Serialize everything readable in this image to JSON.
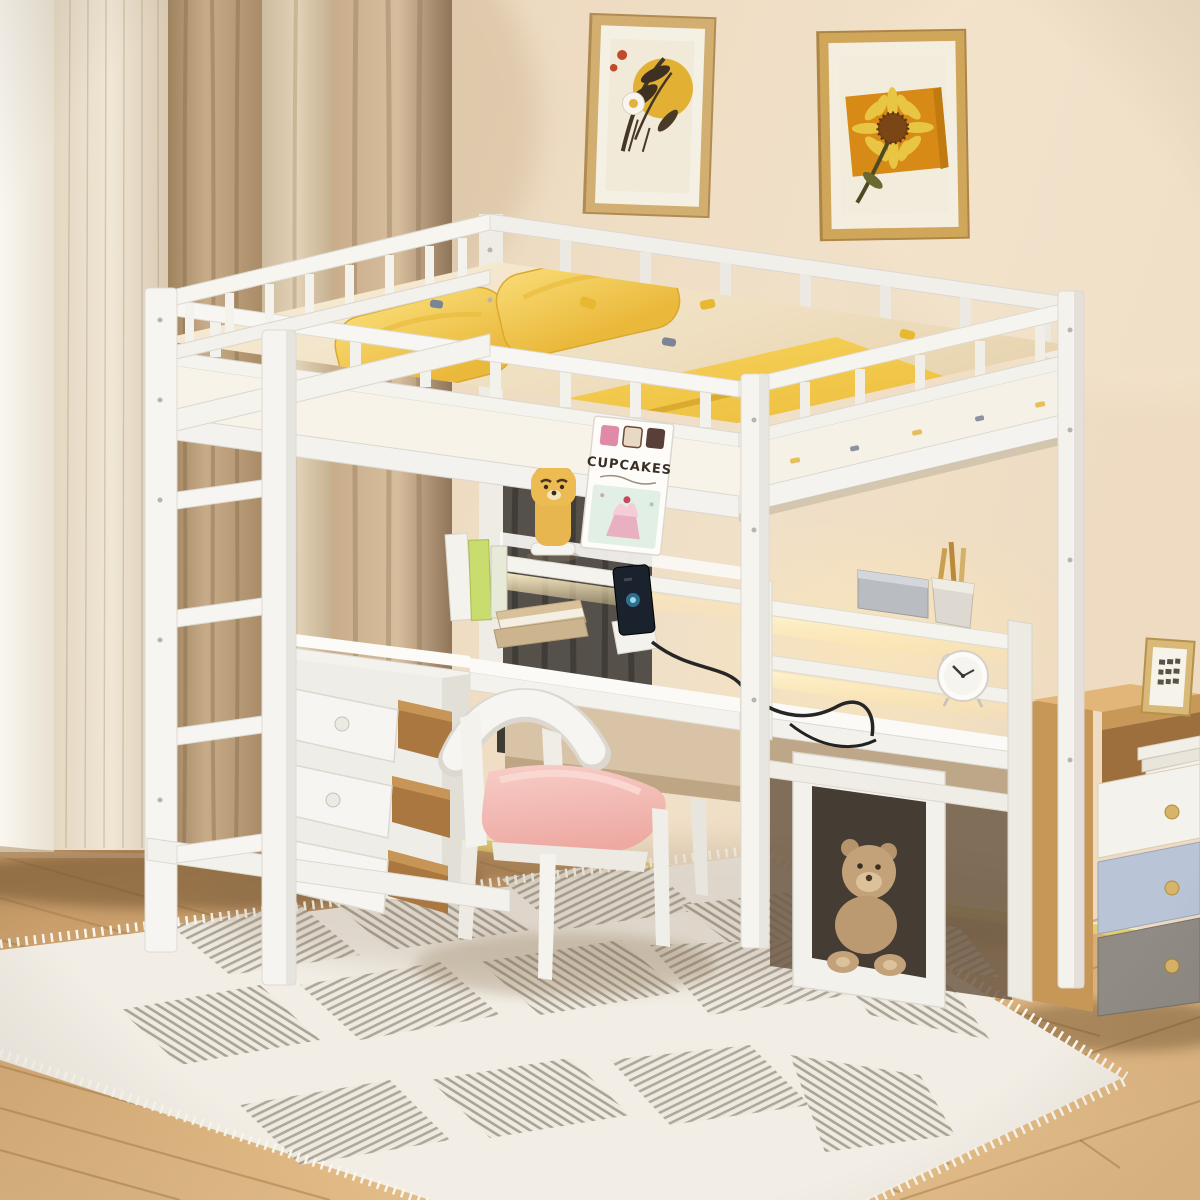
{
  "meta": {
    "kind": "product-photo",
    "subject": "White full-size loft bed with desk, shelves, charging station, storage drawers and ladder in a child's bedroom"
  },
  "book": {
    "title": "CUPCAKES"
  },
  "palette": {
    "bed_white": "#f6f5f1",
    "wall_beige": "#ecd9bf",
    "floor_wood": "#d2a874",
    "rug_cream": "#f2eee5",
    "rug_stripe": "#a59d8f",
    "pillow_yellow": "#f3c84a",
    "blanket_yellow": "#f0c03c",
    "cushion_pink": "#f4c0ba",
    "curtain_beige": "#c9ae8e",
    "nightstand_wood": "#d9aa6b",
    "nightstand_drawer_blue": "#b9c4d6",
    "nightstand_drawer_gray": "#908b84",
    "poster_orange": "#d88a16",
    "poster_yellow": "#e2b134",
    "led_glow": "#ffe9b0",
    "teddy_tan": "#c3a27a"
  },
  "objects": [
    {
      "name": "loft-bed",
      "label": "white wood loft bed with guardrails"
    },
    {
      "name": "ladder",
      "label": "front ladder"
    },
    {
      "name": "mattress",
      "label": "mattress with printed sheet"
    },
    {
      "name": "pillows",
      "label": "two yellow pillows"
    },
    {
      "name": "blanket",
      "label": "yellow blanket"
    },
    {
      "name": "hutch-shelf",
      "label": "under-bed shelves with LED light"
    },
    {
      "name": "desk",
      "label": "built-in L-shaped desk"
    },
    {
      "name": "drawer-unit",
      "label": "three open storage drawers"
    },
    {
      "name": "chair",
      "label": "white chair with pink cushion"
    },
    {
      "name": "cupcakes-book",
      "label": "cupcake recipe book on shelf"
    },
    {
      "name": "bear-figurine",
      "label": "yellow bear figurine"
    },
    {
      "name": "phone",
      "label": "smartphone on charging stand"
    },
    {
      "name": "alarm-clock",
      "label": "white alarm clock"
    },
    {
      "name": "pen-cup",
      "label": "pencil cup"
    },
    {
      "name": "teddy-bear-cube",
      "label": "cube shelf with teddy bear"
    },
    {
      "name": "nightstand",
      "label": "wooden nightstand with three drawers"
    },
    {
      "name": "photo-frame",
      "label": "small picture frame"
    },
    {
      "name": "poster-left",
      "label": "framed botanical print"
    },
    {
      "name": "poster-right",
      "label": "framed sunflower print"
    },
    {
      "name": "curtains",
      "label": "beige curtains"
    },
    {
      "name": "rug",
      "label": "cream chevron rug with fringe"
    },
    {
      "name": "floor",
      "label": "light wood floor"
    }
  ]
}
